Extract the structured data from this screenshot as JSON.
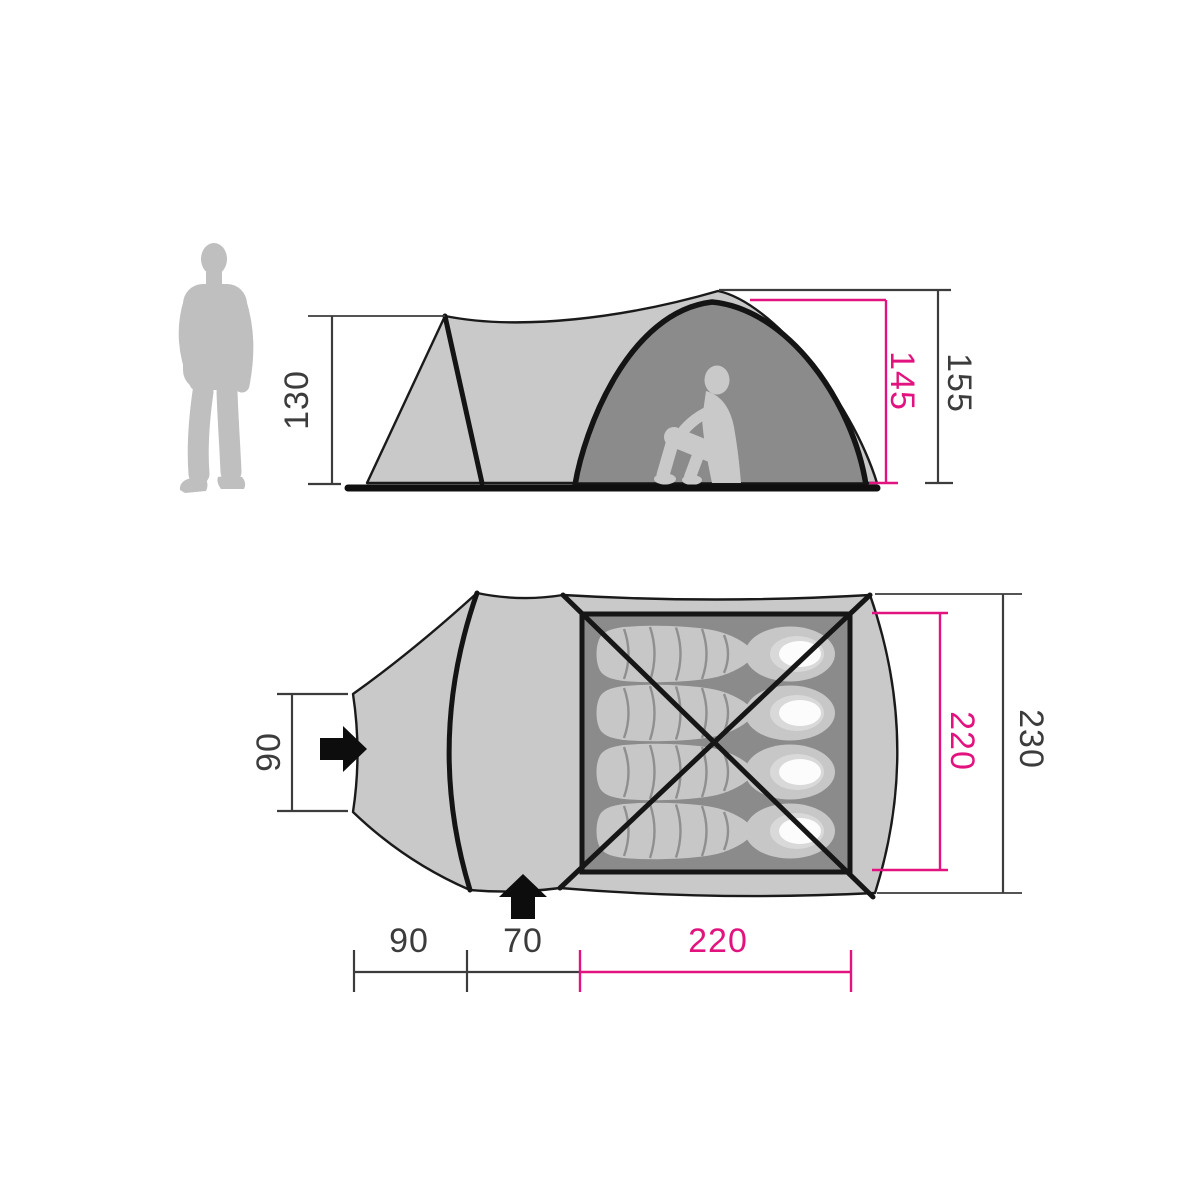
{
  "colors": {
    "accent_pink": "#e2127e",
    "dimension_line": "#3c3c3c",
    "tent_light": "#c9c9c9",
    "tent_dark": "#8b8b8b",
    "outline": "#1a1a1a",
    "figure_gray": "#bfbfbf",
    "pillow_white": "#fcfcfc"
  },
  "side_view": {
    "label_porch_height": "130",
    "label_inner_height": "145",
    "label_outer_height": "155",
    "icons": [
      "standing-person-silhouette",
      "sitting-person-silhouette"
    ]
  },
  "floor_plan": {
    "label_door_width": "90",
    "label_inner_width": "220",
    "label_outer_width": "230",
    "label_porch_length": "90",
    "label_mid_length": "70",
    "label_inner_length": "220",
    "sleeping_bag_count": 4,
    "icons": [
      "entrance-arrow-right-icon",
      "entrance-arrow-up-icon",
      "crossed-poles-icon",
      "sleeping-bag-icon"
    ]
  }
}
